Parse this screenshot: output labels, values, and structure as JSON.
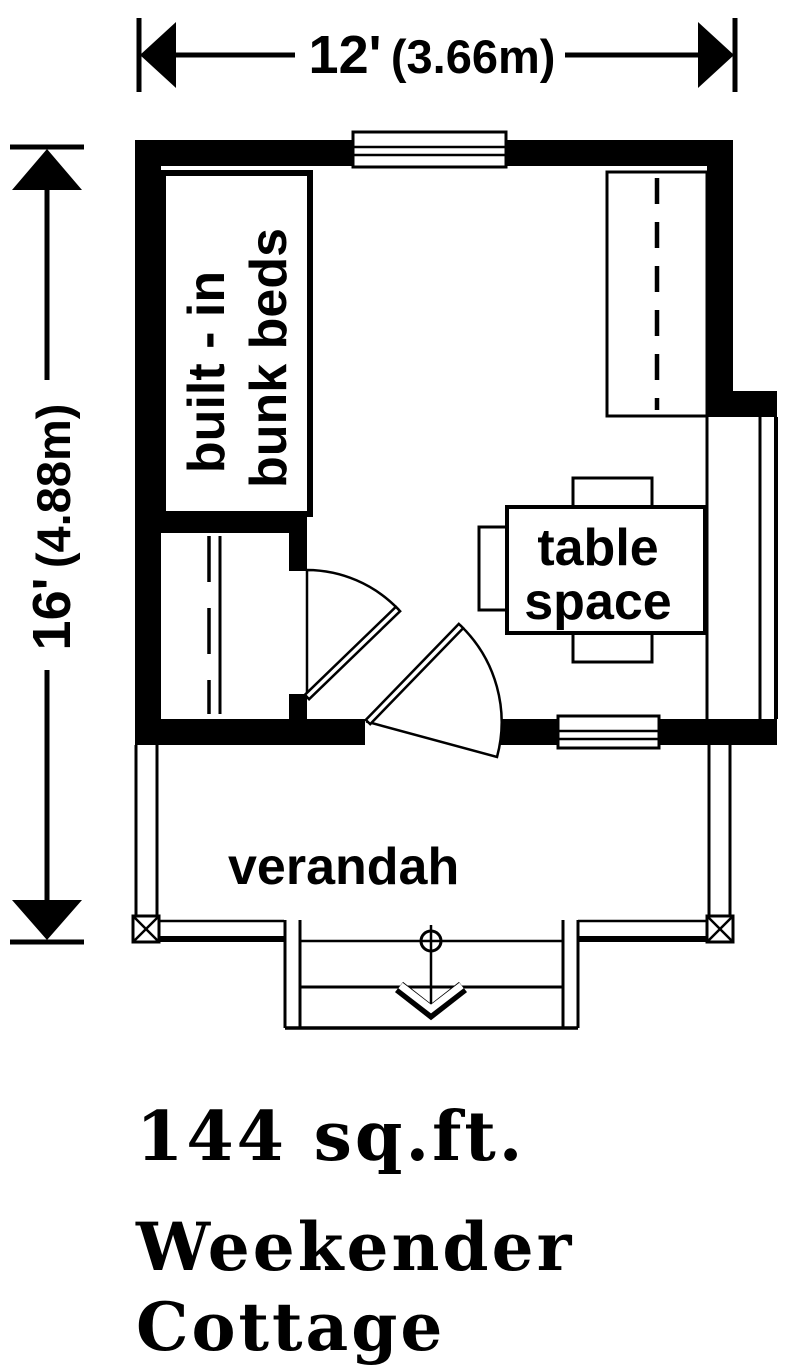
{
  "drawing": {
    "width_dimension": {
      "feet": "12'",
      "metric": "(3.66m)"
    },
    "height_dimension": {
      "feet": "16'",
      "metric": "(4.88m)"
    },
    "labels": {
      "bunk": {
        "line1": "built - in",
        "line2": "bunk beds"
      },
      "table": {
        "line1": "table",
        "line2": "space"
      },
      "verandah": "verandah"
    }
  },
  "footer": {
    "area": "144 sq.ft.",
    "title_line1": "Weekender",
    "title_line2": "Cottage"
  },
  "colors": {
    "ink": "#000000",
    "paper": "#ffffff"
  }
}
